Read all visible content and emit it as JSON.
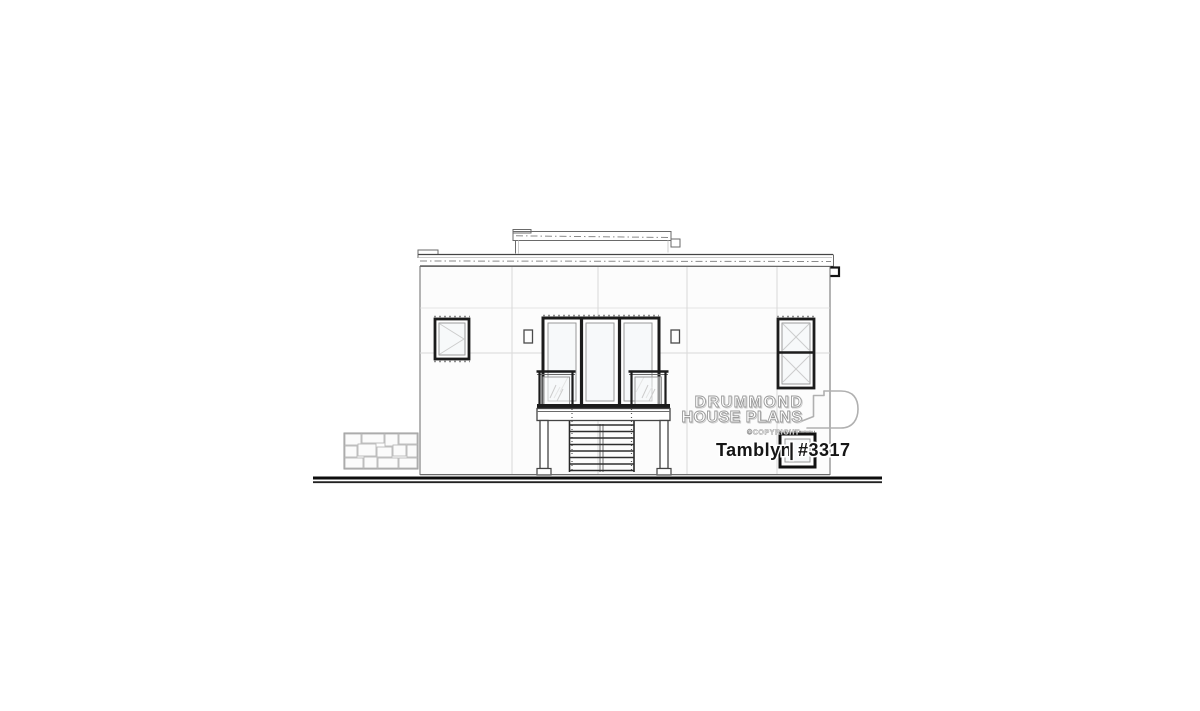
{
  "logo": {
    "line1": "DRUMMOND",
    "line2": "HOUSE PLANS",
    "copyright": "©COPYRIGHT"
  },
  "plan": {
    "name": "Tamblyn",
    "separator": "|",
    "number": "#3317"
  },
  "colors": {
    "line_dark": "#1c1c1c",
    "line_mid": "#444444",
    "line_faint": "#d9d9d9",
    "wall_fill": "#fcfcfc",
    "watermark_gray": "#9a9a9a",
    "ground_black": "#0d0d0d",
    "background": "#ffffff"
  }
}
